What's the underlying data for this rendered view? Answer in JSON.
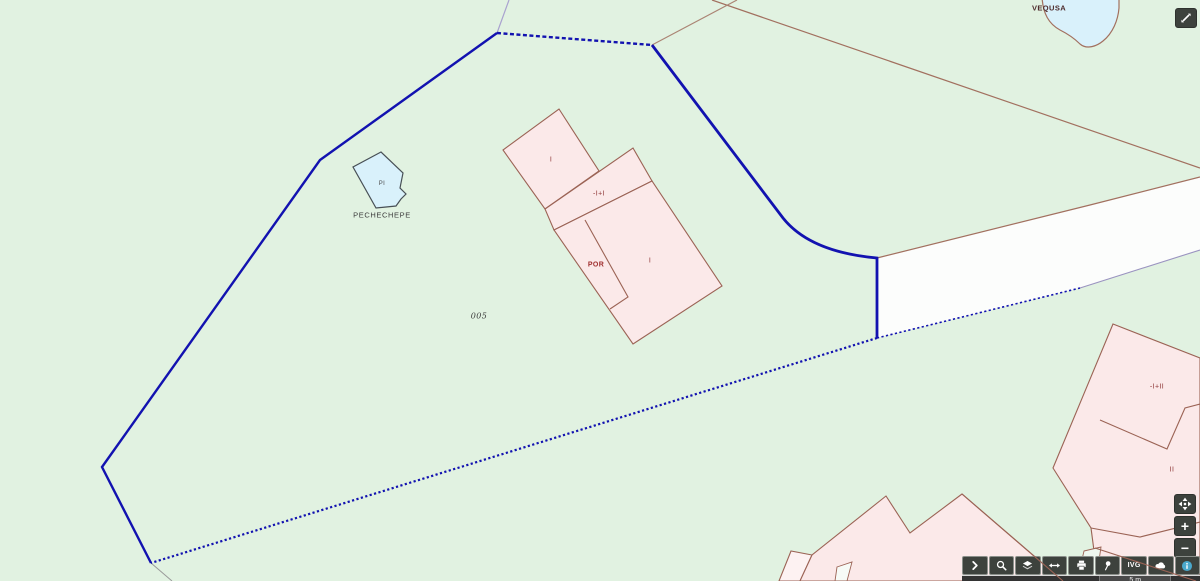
{
  "map": {
    "place_labels": {
      "vequsa": "VEQUSA",
      "pechechepe": "PECHECHEPE",
      "pi": "PI",
      "parcel_005": "005"
    },
    "building_labels": {
      "central_upper": "I",
      "central_mid": "-I+I",
      "central_por": "POR",
      "central_lower": "I",
      "southeast_upper": "-I+II",
      "southeast_lower": "II"
    }
  },
  "controls": {
    "zoom_in": "+",
    "zoom_out": "−"
  },
  "toolbar": {
    "ivg_label": "IVG",
    "button_names": [
      "expand-panel",
      "search",
      "layers",
      "measure",
      "print",
      "pin",
      "ivg",
      "cloud",
      "info"
    ]
  },
  "scalebar": {
    "distance": "5 m"
  },
  "icons": {
    "top_right": "expand-icon",
    "nav": [
      "pan-icon",
      "plus-glyph",
      "minus-glyph"
    ],
    "toolbar": [
      "chevron-right-icon",
      "magnifier-icon",
      "layers-icon",
      "measure-icon",
      "printer-icon",
      "pushpin-icon",
      "text-IVG",
      "cloud-icon",
      "info-icon"
    ]
  },
  "colors": {
    "background": "#e1f2e1",
    "parcel_boundary": "#1212b0",
    "building_fill": "#fbe9e9",
    "building_stroke": "#9b6355",
    "water_fill": "#d9f1fb",
    "road_fill": "#fcfdfc",
    "road_lower_stroke": "#9a93c0",
    "toolbar_button_bg": "#3d423d",
    "info_accent": "#4aa8cc"
  }
}
